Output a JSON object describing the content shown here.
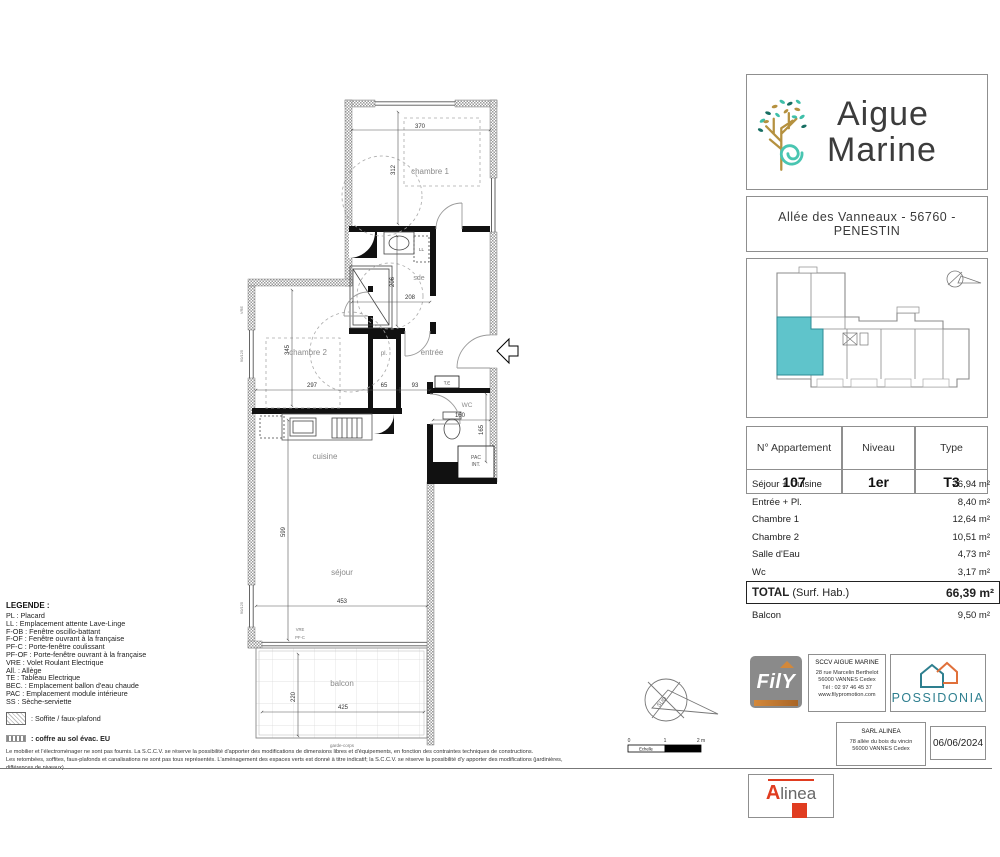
{
  "colors": {
    "teal": "#5fc4cb",
    "gold": "#b5913f",
    "dark_text": "#3c3c3c",
    "possidonia_teal": "#2e7f8f",
    "possidonia_orange": "#e0703a",
    "alinea_red": "#e03c20",
    "unit_highlight": "#5fc4cb"
  },
  "plan": {
    "rooms": {
      "chambre1": "chambre 1",
      "sde": "sde",
      "chambre2": "chambre 2",
      "placard": "pl.",
      "entree": "entrée",
      "wc": "WC",
      "cuisine": "cuisine",
      "sejour": "séjour",
      "balcon": "balcon",
      "pac1": "PAC",
      "pac2": "INT.",
      "ll": "LL",
      "te": "T.E"
    },
    "dims": {
      "chambre1_w": "370",
      "chambre1_h": "312",
      "sde_h": "206",
      "sde_w": "208",
      "chambre2_h": "345",
      "chambre2_w": "297",
      "placard_w": "65",
      "hall_w": "93",
      "wc_w": "160",
      "wc_h": "165",
      "sejour_h": "599",
      "sejour_w": "453",
      "balcon_w": "425",
      "balcon_h": "220"
    },
    "annotations": {
      "vre_bottom": "VRE",
      "pfc_bottom": "PF-C",
      "garde_corps": "garde-corps",
      "window_left1": "90/125",
      "window_left2": "90/125",
      "vre_left": "VRE",
      "compass": "SUD"
    }
  },
  "scalebar": {
    "label": "Echelle",
    "tick0": "0",
    "tick1": "1",
    "tick2": "2 m"
  },
  "legend": {
    "title": "LEGENDE :",
    "items": [
      "PL : Placard",
      "LL : Emplacement attente Lave-Linge",
      "F-OB : Fenêtre oscillo-battant",
      "F-OF : Fenêtre ouvrant à la française",
      "PF-C : Porte-fenêtre coulissant",
      "PF-OF : Porte-fenêtre ouvrant à la française",
      "VRE : Volet Roulant Electrique",
      "All. : Allège",
      "TE : Tableau Electrique",
      "BEC. : Emplacement ballon d'eau chaude",
      "PAC : Emplacement module intérieure",
      "SS : Sèche-serviette"
    ],
    "soffite": ": Soffite / faux-plafond",
    "coffre": ": coffre au sol évac. EU"
  },
  "disclaimer": {
    "line1": "Le mobilier et l'électroménager ne sont pas fournis. La S.C.C.V. se réserve la possibilité d'apporter des modifications de dimensions libres et d'équipements, en fonction des contraintes techniques de constructions.",
    "line2": "Les retombées, soffites, faux-plafonds et canalisations ne sont pas tous représentés. L'aménagement des espaces verts est donné à titre indicatif; la S.C.C.V. se réserve la possibilité d'y apporter des modifications (jardinières, différences de niveaux)."
  },
  "sidebar": {
    "brand": {
      "line1": "Aigue",
      "line2": "Marine"
    },
    "address": "Allée des Vanneaux - 56760 - PENESTIN",
    "apartment": {
      "col1_header": "N° Appartement",
      "col2_header": "Niveau",
      "col3_header": "Type",
      "col1_value": "107",
      "col2_value": "1er",
      "col3_value": "T3"
    },
    "areas": {
      "rows": [
        {
          "label": "Séjour + Cuisine",
          "value": "26,94 m²"
        },
        {
          "label": "Entrée + Pl.",
          "value": "8,40 m²"
        },
        {
          "label": "Chambre 1",
          "value": "12,64 m²"
        },
        {
          "label": "Chambre 2",
          "value": "10,51 m²"
        },
        {
          "label": "Salle d'Eau",
          "value": "4,73 m²"
        },
        {
          "label": "Wc",
          "value": "3,17 m²"
        }
      ],
      "total_label": "TOTAL",
      "total_suffix": " (Surf. Hab.)",
      "total_value": "66,39 m²",
      "balcon_label": "Balcon",
      "balcon_value": "9,50 m²"
    },
    "partners": {
      "fily": {
        "logo_text": "FilY",
        "company": "SCCV AIGUE MARINE",
        "address1": "28 rue Marcelin Berthelot",
        "address2": "56000 VANNES Cedex",
        "phone": "Tél : 02 97 46 45 37",
        "web": "www.filypromotion.com"
      },
      "possidonia": {
        "name": "POSSIDONIA"
      },
      "alinea": {
        "logo_a": "A",
        "logo_rest": "linea",
        "company": "SARL ALINEA",
        "address1": "78 allée du bois du vincin",
        "address2": "56000 VANNES Cedex"
      },
      "date": "06/06/2024"
    }
  }
}
